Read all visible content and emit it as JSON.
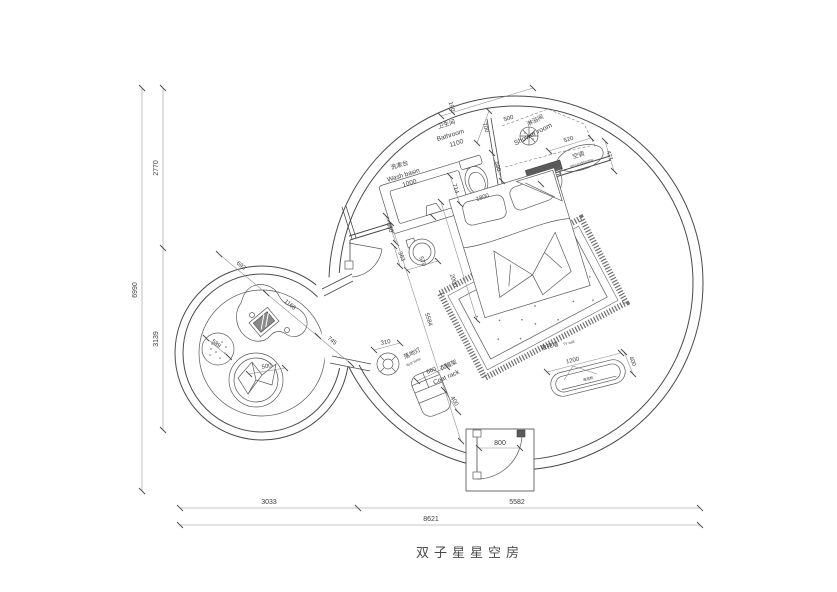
{
  "title": "双子星星空房",
  "colors": {
    "line": "#4a4a4a",
    "background": "#ffffff",
    "dark_fill": "#5a5a5a"
  },
  "labels": {
    "dim_6990": "6990",
    "dim_2770": "2770",
    "dim_3139": "3139",
    "dim_8621": "8621",
    "dim_3033": "3033",
    "dim_5582": "5582",
    "dim_190": "190",
    "dim_700": "700",
    "dim_500_shower": "500",
    "bathroom_cn": "卫生间",
    "bathroom_en": "Bathroom",
    "dim_1100": "1100",
    "washbasin_cn": "洗漱台",
    "washbasin_en": "Wash basin",
    "dim_1000": "1000",
    "dim_550": "550",
    "dim_714": "714",
    "dim_1800": "1800",
    "dim_590": "590",
    "shower_cn": "淋浴间",
    "shower_en": "Shower room",
    "dim_520": "520",
    "dim_421": "421",
    "ac_cn": "空调",
    "ac_en": "air-conditioning",
    "dim_363": "363",
    "dim_570": "570",
    "dim_2000": "2000",
    "dim_5584": "5584",
    "dim_310": "310",
    "floor_lamp_cn": "落地灯",
    "floor_lamp_en": "floor lamp",
    "dim_660": "660",
    "coat_rack_cn": "衣帽架",
    "coat_rack_en": "Coat rack",
    "dim_400_coat": "400",
    "tv_wall_cn": "电视墙",
    "tv_wall_en": "TV wall",
    "dim_1200": "1200",
    "dim_400_tv": "400",
    "tv_cabinet_cn": "电视柜",
    "dim_800": "800",
    "dim_693": "693",
    "dim_1166": "1166",
    "dim_745": "745",
    "dim_589": "589",
    "dim_500_chair": "500"
  }
}
